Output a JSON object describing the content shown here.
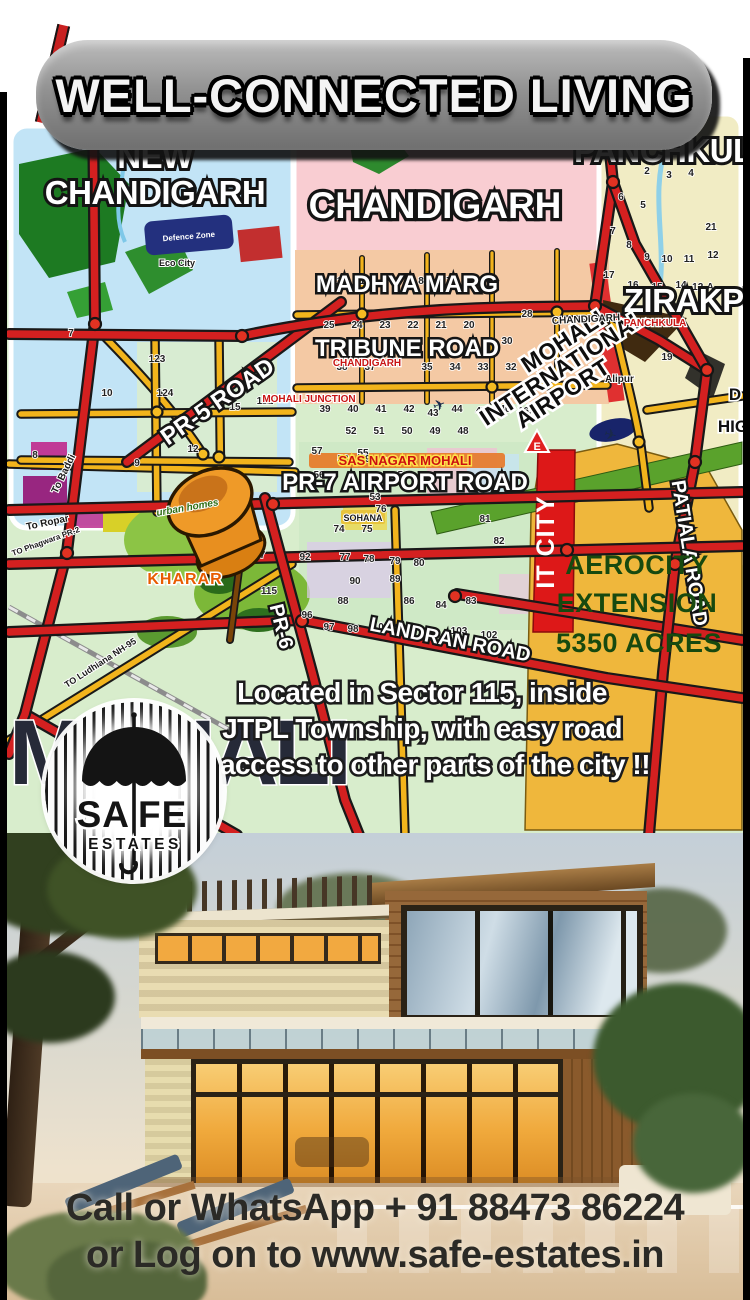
{
  "header": {
    "title": "WELL-CONNECTED LIVING"
  },
  "map": {
    "areas": {
      "new_chd_l1": "NEW",
      "new_chd_l2": "CHANDIGARH",
      "chandigarh": "CHANDIGARH",
      "panchkula": "PANCHKULA",
      "zirakpur": "ZIRAKPUR",
      "kharar": "KHARAR",
      "watermark": "MOHALI",
      "sas_nagar": "SAS NAGAR MOHALI",
      "mohali_junction": "MOHALI JUNCTION",
      "panchkula_small": "PANCHKULA",
      "chandigarh_small": "CHANDIGARH",
      "chandigarh_tag": "CHANDIGARH",
      "alipur": "Alipur",
      "sohana": "SOHANA",
      "urban_homes": "urban homes",
      "eco_city": "Eco City",
      "defence_zone": "Defence Zone",
      "e_sign": "E"
    },
    "roads": {
      "madhya_marg": "MADHYA MARG",
      "tribune_road": "TRIBUNE ROAD",
      "pr5": "PR-5 ROAD",
      "pr7": "PR-7  AIRPORT ROAD",
      "pr6": "PR-6",
      "landran": "LANDRAN ROAD",
      "patiala": "PATIALA ROAD",
      "to_ropar": "To Ropar",
      "to_baddi": "To Baddi",
      "to_ludhiana": "TO Ludhiana NH-95",
      "to_phagwara": "TO Phagwara PR-2",
      "d_clip": "D",
      "hig_clip": "HIG"
    },
    "airport": {
      "l1": "MOHALI",
      "l2": "INTERNATIONAL",
      "l3": "AIRPORT"
    },
    "aerocity": {
      "l1": "AEROCITY",
      "l2": "EXTENSION",
      "l3": "5350 ACRES"
    },
    "it_city": "IT CITY",
    "caption": {
      "l1": "Located in Sector 115, inside",
      "l2": "JTPL Township, with easy road",
      "l3": "access to other parts of the city !!"
    },
    "sector_labels": [
      {
        "t": "11",
        "x": 330,
        "y": 172
      },
      {
        "t": "10",
        "x": 358,
        "y": 172
      },
      {
        "t": "9",
        "x": 386,
        "y": 172
      },
      {
        "t": "8",
        "x": 414,
        "y": 172
      },
      {
        "t": "7",
        "x": 442,
        "y": 172
      },
      {
        "t": "26",
        "x": 472,
        "y": 172
      },
      {
        "t": "25",
        "x": 322,
        "y": 216
      },
      {
        "t": "24",
        "x": 350,
        "y": 216
      },
      {
        "t": "23",
        "x": 378,
        "y": 216
      },
      {
        "t": "22",
        "x": 406,
        "y": 216
      },
      {
        "t": "21",
        "x": 434,
        "y": 216
      },
      {
        "t": "20",
        "x": 462,
        "y": 216
      },
      {
        "t": "28",
        "x": 520,
        "y": 205
      },
      {
        "t": "30",
        "x": 500,
        "y": 232
      },
      {
        "t": "38",
        "x": 335,
        "y": 258
      },
      {
        "t": "37",
        "x": 363,
        "y": 258
      },
      {
        "t": "35",
        "x": 420,
        "y": 258
      },
      {
        "t": "34",
        "x": 448,
        "y": 258
      },
      {
        "t": "33",
        "x": 476,
        "y": 258
      },
      {
        "t": "32",
        "x": 504,
        "y": 258
      },
      {
        "t": "31",
        "x": 532,
        "y": 252
      },
      {
        "t": "39",
        "x": 318,
        "y": 300
      },
      {
        "t": "40",
        "x": 346,
        "y": 300
      },
      {
        "t": "41",
        "x": 374,
        "y": 300
      },
      {
        "t": "42",
        "x": 402,
        "y": 300
      },
      {
        "t": "43",
        "x": 426,
        "y": 304
      },
      {
        "t": "44",
        "x": 450,
        "y": 300
      },
      {
        "t": "45",
        "x": 474,
        "y": 302
      },
      {
        "t": "46",
        "x": 498,
        "y": 300
      },
      {
        "t": "47",
        "x": 524,
        "y": 298
      },
      {
        "t": "52",
        "x": 344,
        "y": 322
      },
      {
        "t": "51",
        "x": 372,
        "y": 322
      },
      {
        "t": "50",
        "x": 400,
        "y": 322
      },
      {
        "t": "49",
        "x": 428,
        "y": 322
      },
      {
        "t": "48",
        "x": 456,
        "y": 322
      },
      {
        "t": "55",
        "x": 356,
        "y": 344
      },
      {
        "t": "56",
        "x": 312,
        "y": 366
      },
      {
        "t": "54",
        "x": 396,
        "y": 366
      },
      {
        "t": "53",
        "x": 368,
        "y": 388
      },
      {
        "t": "2",
        "x": 640,
        "y": 62
      },
      {
        "t": "3",
        "x": 662,
        "y": 66
      },
      {
        "t": "4",
        "x": 684,
        "y": 64
      },
      {
        "t": "6",
        "x": 614,
        "y": 88
      },
      {
        "t": "5",
        "x": 636,
        "y": 96
      },
      {
        "t": "7",
        "x": 606,
        "y": 122
      },
      {
        "t": "8",
        "x": 622,
        "y": 136
      },
      {
        "t": "9",
        "x": 640,
        "y": 148
      },
      {
        "t": "10",
        "x": 660,
        "y": 150
      },
      {
        "t": "11",
        "x": 682,
        "y": 150
      },
      {
        "t": "12",
        "x": 706,
        "y": 146
      },
      {
        "t": "17",
        "x": 602,
        "y": 166
      },
      {
        "t": "16",
        "x": 626,
        "y": 176
      },
      {
        "t": "15",
        "x": 650,
        "y": 178
      },
      {
        "t": "14",
        "x": 674,
        "y": 176
      },
      {
        "t": "21",
        "x": 704,
        "y": 118
      },
      {
        "t": "19",
        "x": 660,
        "y": 248
      },
      {
        "t": "12-A",
        "x": 696,
        "y": 178
      },
      {
        "t": "123",
        "x": 150,
        "y": 250
      },
      {
        "t": "124",
        "x": 158,
        "y": 284
      },
      {
        "t": "121",
        "x": 258,
        "y": 292
      },
      {
        "t": "127",
        "x": 250,
        "y": 446
      },
      {
        "t": "115",
        "x": 262,
        "y": 482
      },
      {
        "t": "92",
        "x": 298,
        "y": 448
      },
      {
        "t": "66A",
        "x": 520,
        "y": 302
      },
      {
        "t": "57",
        "x": 310,
        "y": 342
      },
      {
        "t": "58",
        "x": 336,
        "y": 350
      },
      {
        "t": "59",
        "x": 358,
        "y": 350
      },
      {
        "t": "60",
        "x": 380,
        "y": 352
      },
      {
        "t": "74",
        "x": 332,
        "y": 420
      },
      {
        "t": "75",
        "x": 360,
        "y": 420
      },
      {
        "t": "76",
        "x": 374,
        "y": 400
      },
      {
        "t": "77",
        "x": 338,
        "y": 448
      },
      {
        "t": "78",
        "x": 362,
        "y": 450
      },
      {
        "t": "79",
        "x": 388,
        "y": 452
      },
      {
        "t": "80",
        "x": 412,
        "y": 454
      },
      {
        "t": "81",
        "x": 478,
        "y": 410
      },
      {
        "t": "82",
        "x": 492,
        "y": 432
      },
      {
        "t": "90",
        "x": 348,
        "y": 472
      },
      {
        "t": "89",
        "x": 388,
        "y": 470
      },
      {
        "t": "88",
        "x": 336,
        "y": 492
      },
      {
        "t": "86",
        "x": 402,
        "y": 492
      },
      {
        "t": "84",
        "x": 434,
        "y": 496
      },
      {
        "t": "83",
        "x": 464,
        "y": 492
      },
      {
        "t": "96",
        "x": 300,
        "y": 506
      },
      {
        "t": "97",
        "x": 322,
        "y": 518
      },
      {
        "t": "98",
        "x": 346,
        "y": 520
      },
      {
        "t": "100",
        "x": 374,
        "y": 518
      },
      {
        "t": "103",
        "x": 452,
        "y": 522
      },
      {
        "t": "102",
        "x": 482,
        "y": 526
      },
      {
        "t": "7",
        "x": 64,
        "y": 224
      },
      {
        "t": "10",
        "x": 100,
        "y": 284
      },
      {
        "t": "15",
        "x": 228,
        "y": 298
      },
      {
        "t": "12",
        "x": 186,
        "y": 340
      },
      {
        "t": "8",
        "x": 28,
        "y": 346
      },
      {
        "t": "9",
        "x": 130,
        "y": 354
      }
    ]
  },
  "icons": {
    "plane": "✈"
  },
  "colors": {
    "road_red": "#d42020",
    "road_yellow": "#f2b41c",
    "aerocity_fill": "#efb73c",
    "it_city_red": "#dd1818"
  },
  "logo": {
    "part1": "SA",
    "part2": "FE",
    "line2": "ESTATES"
  },
  "footer": {
    "line1": "Call or WhatsApp + 91 88473 86224",
    "line2": "or Log on to www.safe-estates.in"
  }
}
